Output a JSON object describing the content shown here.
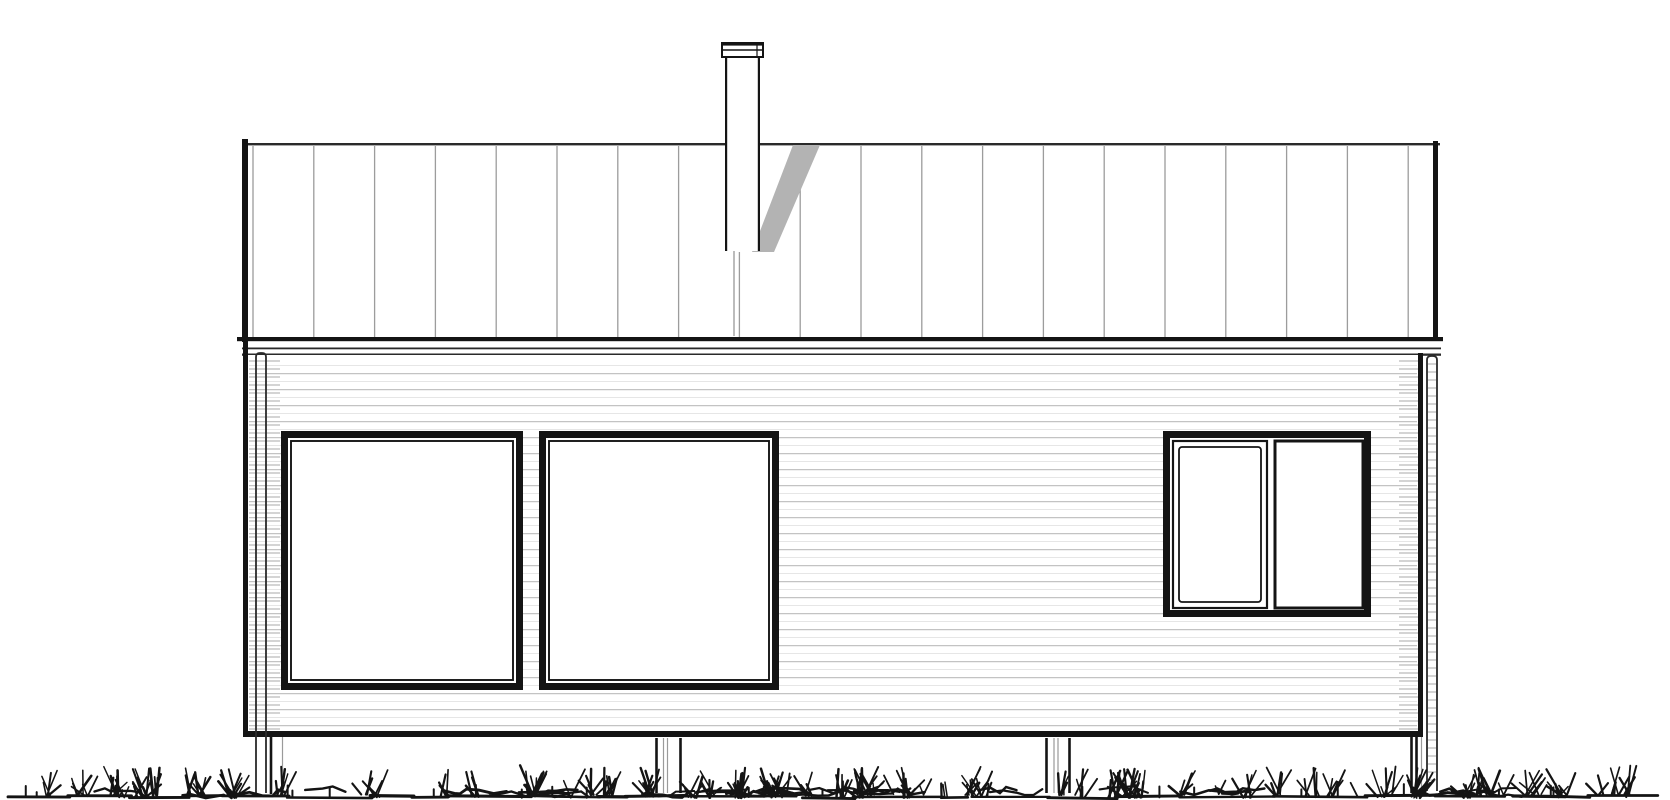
{
  "drawing": {
    "kind": "house-elevation-line-drawing",
    "canvas": {
      "width": 1670,
      "height": 800,
      "background": "#ffffff"
    },
    "colors": {
      "ink": "#141414",
      "ink_soft": "#2a2a2a",
      "roof_seam": "#9c9c9c",
      "siding_main": "#c3c3c3",
      "siding_faint": "#e6e6e6",
      "corner_hatch": "#a8a8a8",
      "shadow_gray": "#b3b3b3",
      "hidden_line_gray": "#ababab",
      "post_gray": "#9a9a9a"
    },
    "roof": {
      "x1": 242,
      "x2": 1440,
      "top_edge": {
        "y": 143,
        "h": 2.4
      },
      "left_rake": {
        "x": 242,
        "w": 6,
        "y1": 139,
        "y2": 342
      },
      "right_rake": {
        "x": 1433,
        "w": 5,
        "y1": 141,
        "y2": 340
      },
      "eave": {
        "x1": 237,
        "x2": 1443,
        "y": 337,
        "h": 4.2
      },
      "fascia_lines": [
        {
          "x1": 242,
          "x2": 1441,
          "y": 347.5,
          "h": 1.8
        },
        {
          "x1": 242,
          "x2": 1441,
          "y": 353.5,
          "h": 2.3
        }
      ],
      "seams": {
        "x_start": 253,
        "spacing": 60.8,
        "count": 20,
        "y1": 146,
        "y2": 337,
        "w": 1.3
      }
    },
    "chimney": {
      "flue": {
        "x1": 725,
        "x2": 760,
        "y1": 50,
        "y2": 251,
        "side_w": 2.2
      },
      "cap": {
        "x1": 722,
        "x2": 763,
        "y1": 43,
        "y2": 57,
        "mid_line_y": 50,
        "notch_x": 757
      },
      "hidden_flue_line": {
        "x": 734,
        "y1": 251,
        "y2": 336,
        "w": 1.6
      },
      "shadow_polygon": "793,145 820,145 774,252 752,252"
    },
    "wall": {
      "x1": 243,
      "x2": 1423,
      "y_top": 338,
      "y_bottom": 737,
      "edge_w": 5,
      "right_edge_y_top": 353,
      "bottom_band": {
        "y": 731,
        "h": 6
      },
      "siding": {
        "x1": 249,
        "x2": 1417,
        "main_y_start": 373,
        "faint_y_start": 365,
        "spacing": 16,
        "y_end": 727,
        "main_w": 1.25,
        "faint_w": 1
      },
      "corner_hatch_strips": [
        {
          "x1": 249,
          "x2": 280,
          "y1": 361,
          "y2": 729,
          "spacing": 8
        },
        {
          "x1": 1399,
          "x2": 1418,
          "y1": 361,
          "y2": 729,
          "spacing": 8
        }
      ]
    },
    "windows": [
      {
        "id": "window-left",
        "x1": 281,
        "y1": 431,
        "x2": 523,
        "y2": 690,
        "frame_w": 7,
        "inner_inset": 10,
        "inner_w": 1.9
      },
      {
        "id": "window-middle",
        "x1": 539,
        "y1": 431,
        "x2": 779,
        "y2": 690,
        "frame_w": 7,
        "inner_inset": 10,
        "inner_w": 1.9
      },
      {
        "id": "window-right",
        "x1": 1163,
        "y1": 431,
        "x2": 1371,
        "y2": 617,
        "frame_w": 7,
        "casement_sash": {
          "x1": 1173,
          "y1": 441,
          "x2": 1267,
          "y2": 608,
          "outer_w": 2.2,
          "inner_inset": 6,
          "inner_w": 1.8
        },
        "fixed_pane": {
          "x1": 1275,
          "y1": 441,
          "x2": 1363,
          "y2": 608,
          "stroke_w": 3
        }
      }
    ],
    "downspouts": [
      {
        "x": 256,
        "w": 10,
        "y1": 353,
        "y2": 793,
        "hatch": false
      },
      {
        "x": 1427,
        "w": 10,
        "y1": 356,
        "y2": 791,
        "hatch": true,
        "hatch_y1": 364,
        "hatch_y2": 786,
        "hatch_spacing": 8
      }
    ],
    "posts": [
      {
        "y1": 737,
        "y2": 794,
        "dark_lines": [
          271
        ],
        "gray_lines": [
          282.5
        ]
      },
      {
        "y1": 738,
        "y2": 793,
        "dark_lines": [
          656.5,
          680.5
        ],
        "gray_lines": [
          663.5,
          667.5
        ]
      },
      {
        "y1": 738,
        "y2": 793,
        "dark_lines": [
          1046.5,
          1069.5
        ],
        "gray_lines": [
          1054,
          1058
        ]
      },
      {
        "y1": 737,
        "y2": 793,
        "dark_lines": [
          1411.5,
          1416.5
        ],
        "gray_lines": [
          1421.5
        ]
      }
    ],
    "ground": {
      "x1": 8,
      "x2": 1662,
      "baseline_y": 796,
      "tuft_top_y": 763,
      "seed": 11,
      "tuft_count": 150,
      "dark_line_w": 2.6,
      "gray_line_w": 1.2
    }
  }
}
